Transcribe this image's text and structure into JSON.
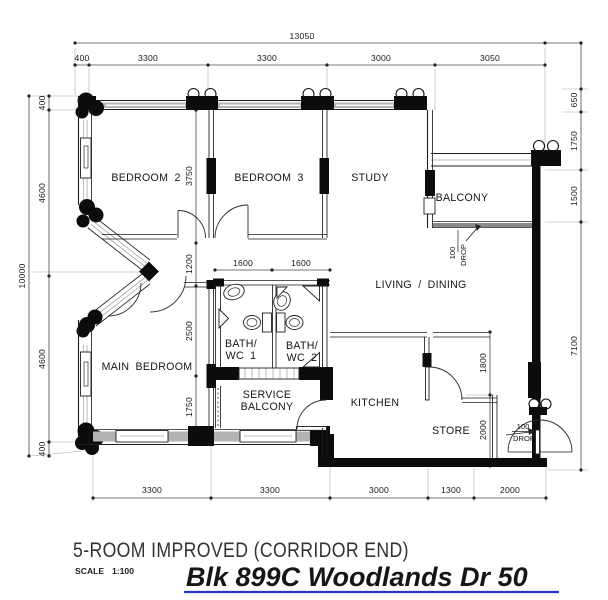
{
  "document": {
    "type_label": "5-ROOM IMPROVED (CORRIDOR END)",
    "scale_label": "SCALE",
    "scale_value": "1:100",
    "handwritten_note": "Blk 899C Woodlands Dr 50",
    "note_color": "#2434cd"
  },
  "rooms": {
    "bedroom2": "BEDROOM 2",
    "bedroom3": "BEDROOM 3",
    "study": "STUDY",
    "balcony": "BALCONY",
    "living_dining": "LIVING / DINING",
    "main_bedroom": "MAIN BEDROOM",
    "bath1_line1": "BATH/",
    "bath1_line2": "WC 1",
    "bath2_line1": "BATH/",
    "bath2_line2": "WC 2",
    "service_line1": "SERVICE",
    "service_line2": "BALCONY",
    "kitchen": "KITCHEN",
    "store": "STORE"
  },
  "dims": {
    "overall_width": "13050",
    "overall_height": "10000",
    "top": [
      "400",
      "3300",
      "3300",
      "3000",
      "3050"
    ],
    "left": [
      "400",
      "4600",
      "4600",
      "400"
    ],
    "right": [
      "650",
      "1750",
      "1500",
      "7100"
    ],
    "bottom": [
      "3300",
      "3300",
      "3000",
      "1300",
      "2000"
    ],
    "interior_vertical": [
      "3750",
      "1200",
      "2500",
      "1750"
    ],
    "bath_width": [
      "1600",
      "1600"
    ],
    "kitchen_right": [
      "1800",
      "2000"
    ],
    "drop_value": "100",
    "drop_word": "DROP"
  }
}
